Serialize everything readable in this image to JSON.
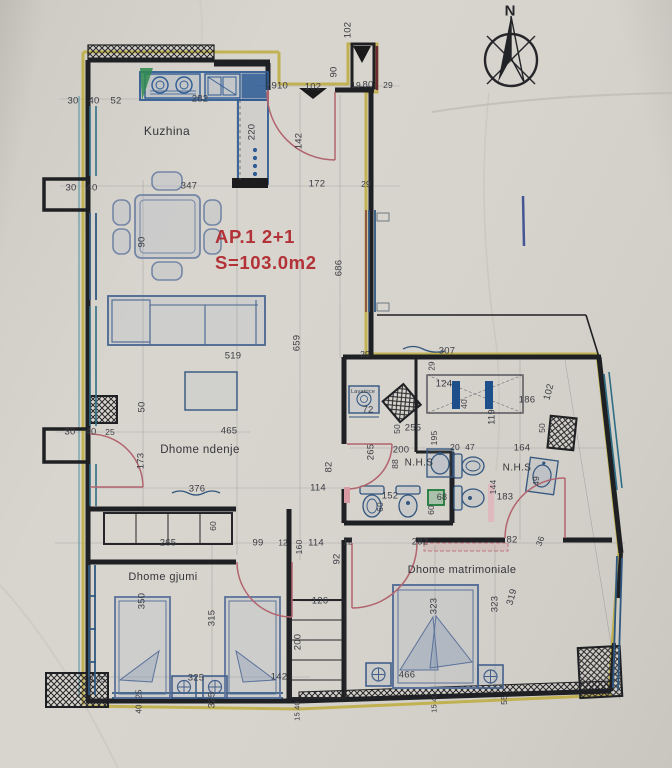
{
  "title": {
    "line1": "AP.1  2+1",
    "line2": "S=103.0m2"
  },
  "compass": {
    "label": "N"
  },
  "colors": {
    "paper": "#d7d4cd",
    "wall": "#1f2023",
    "furniture_blue": "#33567f",
    "insulation_yellow": "#bfae45",
    "window_teal": "#2f6e86",
    "window_blue": "#2f5880",
    "door_pink": "#b2646e",
    "title_red": "#b23237",
    "accent_green": "#2e8b4f"
  },
  "labels": [
    {
      "t": "Kuzhina",
      "x": 167,
      "y": 131,
      "cls": "room",
      "s": 12
    },
    {
      "t": "Dhome ndenje",
      "x": 200,
      "y": 450,
      "cls": "room"
    },
    {
      "t": "Dhome gjumi",
      "x": 163,
      "y": 577,
      "cls": "room",
      "s": 11
    },
    {
      "t": "Dhome matrimoniale",
      "x": 462,
      "y": 570,
      "cls": "room",
      "s": 11
    },
    {
      "t": "N.H.S",
      "x": 419,
      "y": 463,
      "cls": "room",
      "s": 10
    },
    {
      "t": "N.H.S",
      "x": 517,
      "y": 468,
      "cls": "room",
      "s": 10
    },
    {
      "t": "Lavatrice",
      "x": 363,
      "y": 392,
      "s": 5.5
    },
    {
      "t": "N",
      "x": 510,
      "y": 11,
      "cls": "compass"
    },
    {
      "t": "30",
      "x": 73,
      "y": 101
    },
    {
      "t": "40",
      "x": 94,
      "y": 101
    },
    {
      "t": "52",
      "x": 116,
      "y": 101
    },
    {
      "t": "282",
      "x": 200,
      "y": 99
    },
    {
      "t": "2910",
      "x": 277,
      "y": 86
    },
    {
      "t": "102",
      "x": 313,
      "y": 87
    },
    {
      "t": "90",
      "x": 334,
      "y": 72,
      "r": -90
    },
    {
      "t": "19",
      "x": 356,
      "y": 85,
      "s": 8.5
    },
    {
      "t": "80",
      "x": 368,
      "y": 85
    },
    {
      "t": "29",
      "x": 388,
      "y": 85,
      "s": 8.5
    },
    {
      "t": "102",
      "x": 348,
      "y": 30,
      "r": -90
    },
    {
      "t": "220",
      "x": 252,
      "y": 132,
      "r": -90
    },
    {
      "t": "142",
      "x": 299,
      "y": 141,
      "r": -90
    },
    {
      "t": "172",
      "x": 317,
      "y": 184
    },
    {
      "t": "29",
      "x": 366,
      "y": 184,
      "s": 8.5
    },
    {
      "t": "347",
      "x": 189,
      "y": 186
    },
    {
      "t": "30",
      "x": 71,
      "y": 188
    },
    {
      "t": "40",
      "x": 92,
      "y": 188
    },
    {
      "t": "90",
      "x": 142,
      "y": 242,
      "r": -90
    },
    {
      "t": "686",
      "x": 339,
      "y": 268,
      "r": -90
    },
    {
      "t": "659",
      "x": 297,
      "y": 343,
      "r": -90
    },
    {
      "t": "519",
      "x": 233,
      "y": 356
    },
    {
      "t": "465",
      "x": 229,
      "y": 431
    },
    {
      "t": "50",
      "x": 142,
      "y": 407,
      "r": -90
    },
    {
      "t": "173",
      "x": 141,
      "y": 461,
      "r": -90
    },
    {
      "t": "376",
      "x": 197,
      "y": 489
    },
    {
      "t": "114",
      "x": 318,
      "y": 488
    },
    {
      "t": "82",
      "x": 329,
      "y": 467,
      "r": -90
    },
    {
      "t": "30",
      "x": 70,
      "y": 432
    },
    {
      "t": "40",
      "x": 91,
      "y": 432
    },
    {
      "t": "25",
      "x": 110,
      "y": 432,
      "s": 8.5
    },
    {
      "t": "307",
      "x": 447,
      "y": 351
    },
    {
      "t": "29",
      "x": 365,
      "y": 354,
      "s": 8.5
    },
    {
      "t": "29",
      "x": 432,
      "y": 366,
      "r": -90,
      "s": 8
    },
    {
      "t": "124",
      "x": 444,
      "y": 384
    },
    {
      "t": "40",
      "x": 464,
      "y": 404,
      "r": -90,
      "s": 8.5
    },
    {
      "t": "186",
      "x": 527,
      "y": 400
    },
    {
      "t": "102",
      "x": 549,
      "y": 392,
      "r": -75
    },
    {
      "t": "119",
      "x": 492,
      "y": 417,
      "r": -90
    },
    {
      "t": "72",
      "x": 368,
      "y": 410
    },
    {
      "t": "255",
      "x": 413,
      "y": 428
    },
    {
      "t": "50",
      "x": 397,
      "y": 429,
      "r": -90,
      "s": 8.5
    },
    {
      "t": "195",
      "x": 434,
      "y": 438,
      "r": -90,
      "s": 8.5
    },
    {
      "t": "200",
      "x": 401,
      "y": 450
    },
    {
      "t": "88",
      "x": 395,
      "y": 464,
      "r": -90,
      "s": 8.5
    },
    {
      "t": "20",
      "x": 455,
      "y": 447,
      "s": 8.5
    },
    {
      "t": "47",
      "x": 470,
      "y": 447,
      "s": 8.5
    },
    {
      "t": "164",
      "x": 522,
      "y": 448
    },
    {
      "t": "50",
      "x": 542,
      "y": 428,
      "r": -90,
      "s": 8.5
    },
    {
      "t": "265",
      "x": 371,
      "y": 452,
      "r": -90
    },
    {
      "t": "152",
      "x": 390,
      "y": 496
    },
    {
      "t": "60",
      "x": 380,
      "y": 507,
      "r": -90,
      "s": 8.5
    },
    {
      "t": "68",
      "x": 442,
      "y": 497,
      "s": 9
    },
    {
      "t": "60",
      "x": 431,
      "y": 510,
      "r": -90,
      "s": 8.5
    },
    {
      "t": "144",
      "x": 493,
      "y": 487,
      "r": -90,
      "s": 8.5
    },
    {
      "t": "183",
      "x": 505,
      "y": 497
    },
    {
      "t": "49",
      "x": 536,
      "y": 481,
      "r": -90,
      "s": 8.5
    },
    {
      "t": "265",
      "x": 168,
      "y": 543
    },
    {
      "t": "60",
      "x": 213,
      "y": 526,
      "r": -90,
      "s": 8.5
    },
    {
      "t": "99",
      "x": 258,
      "y": 543
    },
    {
      "t": "12",
      "x": 283,
      "y": 543,
      "s": 8
    },
    {
      "t": "160",
      "x": 299,
      "y": 547,
      "r": -90,
      "s": 8.5
    },
    {
      "t": "114",
      "x": 316,
      "y": 543
    },
    {
      "t": "12",
      "x": 348,
      "y": 542,
      "s": 8
    },
    {
      "t": "92",
      "x": 337,
      "y": 559,
      "r": -90
    },
    {
      "t": "282",
      "x": 420,
      "y": 542
    },
    {
      "t": "82",
      "x": 512,
      "y": 540
    },
    {
      "t": "36",
      "x": 540,
      "y": 541,
      "r": -70,
      "s": 8.5
    },
    {
      "t": "126",
      "x": 320,
      "y": 601
    },
    {
      "t": "200",
      "x": 298,
      "y": 642,
      "r": -90
    },
    {
      "t": "350",
      "x": 142,
      "y": 601,
      "r": -90
    },
    {
      "t": "315",
      "x": 212,
      "y": 618,
      "r": -90
    },
    {
      "t": "0 25",
      "x": 97,
      "y": 679,
      "s": 8.5
    },
    {
      "t": "325",
      "x": 196,
      "y": 678
    },
    {
      "t": "142",
      "x": 279,
      "y": 677
    },
    {
      "t": "25",
      "x": 139,
      "y": 694,
      "r": -90,
      "s": 8
    },
    {
      "t": "40",
      "x": 139,
      "y": 709,
      "r": -90,
      "s": 8
    },
    {
      "t": "325",
      "x": 212,
      "y": 700,
      "r": -90
    },
    {
      "t": "15 40",
      "x": 297,
      "y": 711,
      "r": -90,
      "s": 7.5
    },
    {
      "t": "323",
      "x": 434,
      "y": 606,
      "r": -90
    },
    {
      "t": "323",
      "x": 495,
      "y": 604,
      "r": -90
    },
    {
      "t": "319",
      "x": 512,
      "y": 597,
      "r": -75
    },
    {
      "t": "466",
      "x": 407,
      "y": 675
    },
    {
      "t": "15 40",
      "x": 434,
      "y": 703,
      "r": -90,
      "s": 7.5
    },
    {
      "t": "55",
      "x": 504,
      "y": 700,
      "r": -90,
      "s": 8.5
    }
  ]
}
